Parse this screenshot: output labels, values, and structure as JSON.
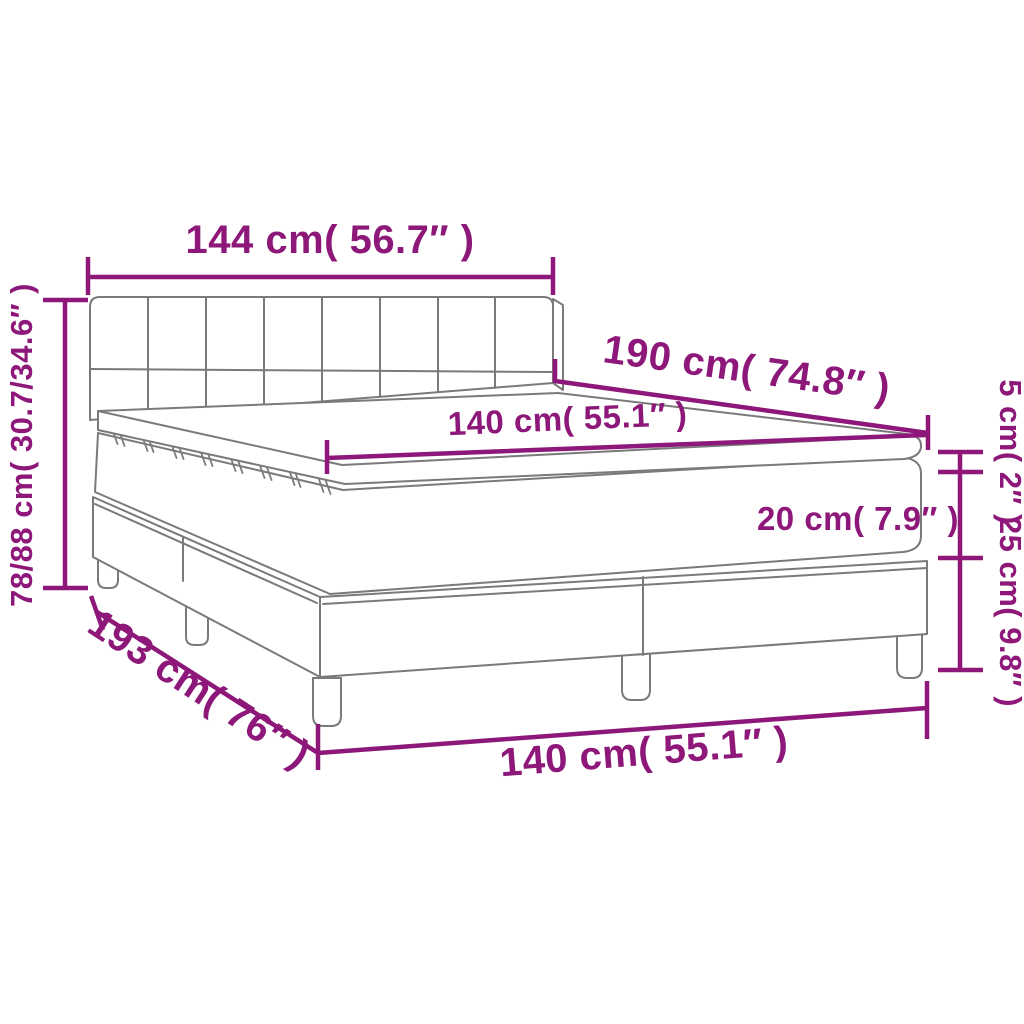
{
  "diagram": {
    "colors": {
      "dimension_accent": "#8d1879",
      "outline_gray": "#7a7a7a",
      "background": "#ffffff"
    },
    "dimensions": {
      "headboard_width": {
        "label": "144 cm( 56.7″ )"
      },
      "total_height": {
        "label": "78/88 cm( 30.7/34.6″ )"
      },
      "mattress_length": {
        "label": "190 cm( 74.8″ )"
      },
      "mattress_width_top": {
        "label": "140 cm( 55.1″ )"
      },
      "topper_height": {
        "label": "5 cm( 2″ )"
      },
      "mattress_height": {
        "label": "20 cm( 7.9″ )"
      },
      "base_height": {
        "label": "25 cm( 9.8″ )"
      },
      "total_length": {
        "label": "193 cm( 76″ )"
      },
      "mattress_width_bottom": {
        "label": "140 cm( 55.1″ )"
      }
    }
  }
}
